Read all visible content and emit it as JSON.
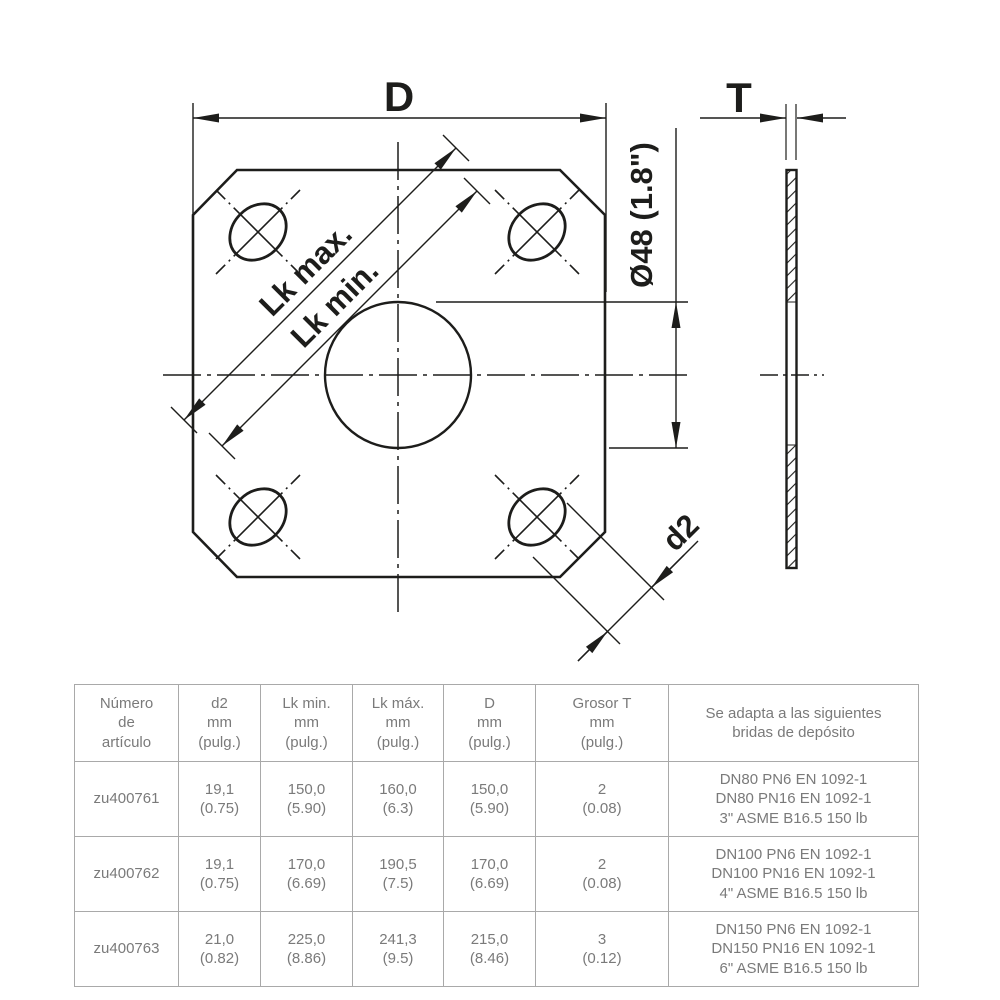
{
  "page": {
    "background": "#ffffff"
  },
  "drawing": {
    "line_color": "#1d1d1b",
    "labels": {
      "width": "D",
      "thickness": "T",
      "bolt_circle_max": "Lk max.",
      "bolt_circle_min": "Lk min.",
      "center_hole_diameter": "Ø48 (1.8\")",
      "bolt_hole_diameter": "d2"
    }
  },
  "table": {
    "border_color": "#a9a9a9",
    "text_color": "#7a7a7a",
    "headers": [
      "Número\nde\nartículo",
      "d2\nmm\n(pulg.)",
      "Lk min.\nmm\n(pulg.)",
      "Lk máx.\nmm\n(pulg.)",
      "D\nmm\n(pulg.)",
      "Grosor T\nmm\n(pulg.)",
      "Se adapta a las siguientes\nbridas de depósito"
    ],
    "rows": [
      [
        "zu400761",
        "19,1\n(0.75)",
        "150,0\n(5.90)",
        "160,0\n(6.3)",
        "150,0\n(5.90)",
        "2\n(0.08)",
        "DN80 PN6 EN 1092-1\nDN80 PN16 EN 1092-1\n3\" ASME B16.5 150 lb"
      ],
      [
        "zu400762",
        "19,1\n(0.75)",
        "170,0\n(6.69)",
        "190,5\n(7.5)",
        "170,0\n(6.69)",
        "2\n(0.08)",
        "DN100 PN6 EN 1092-1\nDN100 PN16 EN 1092-1\n4\" ASME B16.5 150 lb"
      ],
      [
        "zu400763",
        "21,0\n(0.82)",
        "225,0\n(8.86)",
        "241,3\n(9.5)",
        "215,0\n(8.46)",
        "3\n(0.12)",
        "DN150 PN6 EN 1092-1\nDN150 PN16 EN 1092-1\n6\" ASME B16.5 150 lb"
      ]
    ]
  }
}
